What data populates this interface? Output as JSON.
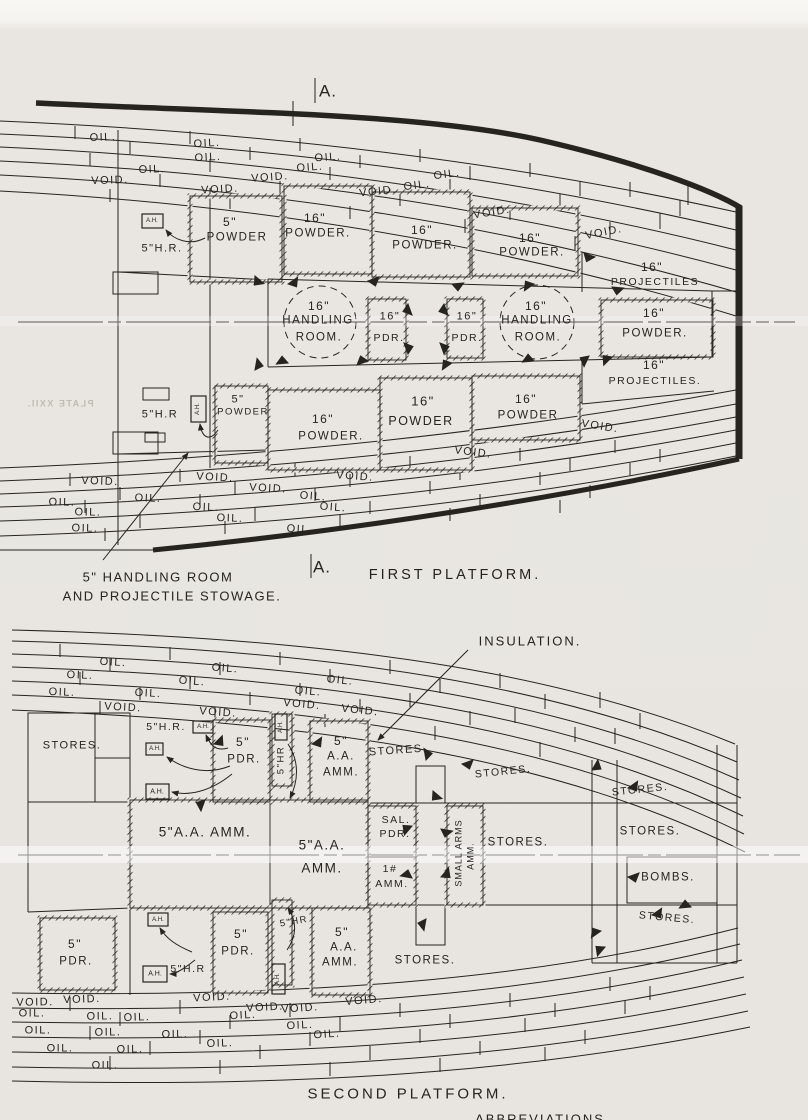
{
  "colors": {
    "paper": "#e8e5e0",
    "ink": "#26241f"
  },
  "figure": {
    "type": "warship deck plan, scanned technical drawing",
    "plans": [
      "FIRST PLATFORM.",
      "SECOND PLATFORM."
    ],
    "watermark": "PLATE XXII."
  },
  "labels": [
    {
      "t": "A.",
      "x": 328,
      "y": 91,
      "s": 17,
      "sp": 1,
      "n": "section-marker-a-top"
    },
    {
      "t": "OIL.",
      "x": 103,
      "y": 138,
      "r": -2
    },
    {
      "t": "OIL.",
      "x": 207,
      "y": 144,
      "r": -3
    },
    {
      "t": "OIL.",
      "x": 208,
      "y": 158,
      "r": -3
    },
    {
      "t": "OIL.",
      "x": 328,
      "y": 158,
      "r": -4
    },
    {
      "t": "OIL.",
      "x": 152,
      "y": 170,
      "r": -2
    },
    {
      "t": "OIL.",
      "x": 310,
      "y": 168,
      "r": -4
    },
    {
      "t": "OIL.",
      "x": 447,
      "y": 175,
      "r": -7
    },
    {
      "t": "OIL.",
      "x": 417,
      "y": 186,
      "r": -7
    },
    {
      "t": "VOID.",
      "x": 110,
      "y": 181,
      "r": -2
    },
    {
      "t": "VOID.",
      "x": 270,
      "y": 178,
      "r": -4
    },
    {
      "t": "VOID.",
      "x": 220,
      "y": 190,
      "r": -3
    },
    {
      "t": "VOID.",
      "x": 378,
      "y": 192,
      "r": -6
    },
    {
      "t": "VOID.",
      "x": 492,
      "y": 213,
      "r": -9
    },
    {
      "t": "VOID.",
      "x": 604,
      "y": 233,
      "r": -11
    },
    {
      "t": "A.H.",
      "x": 152,
      "y": 221,
      "s": 6,
      "sp": 0,
      "n": "ammunition-hoist-box"
    },
    {
      "t": "5\"H.R.",
      "x": 162,
      "y": 249,
      "s": 11,
      "n": "five-inch-handling-room"
    },
    {
      "t": "5\"",
      "x": 230,
      "y": 222,
      "s": 12
    },
    {
      "t": "POWDER",
      "x": 237,
      "y": 238,
      "s": 11.5
    },
    {
      "t": "16\"",
      "x": 315,
      "y": 218,
      "s": 12
    },
    {
      "t": "POWDER.",
      "x": 318,
      "y": 234,
      "s": 11.5
    },
    {
      "t": "16\"",
      "x": 422,
      "y": 230,
      "s": 12
    },
    {
      "t": "POWDER.",
      "x": 425,
      "y": 246,
      "s": 11.5
    },
    {
      "t": "16\"",
      "x": 530,
      "y": 238,
      "s": 12
    },
    {
      "t": "POWDER.",
      "x": 532,
      "y": 253,
      "s": 11.5
    },
    {
      "t": "16\"",
      "x": 652,
      "y": 267,
      "s": 12
    },
    {
      "t": "PROJECTILES",
      "x": 655,
      "y": 282,
      "s": 10.5
    },
    {
      "t": "16\"",
      "x": 319,
      "y": 306,
      "s": 12
    },
    {
      "t": "HANDLING",
      "x": 318,
      "y": 321,
      "s": 11.5
    },
    {
      "t": "ROOM.",
      "x": 319,
      "y": 338,
      "s": 11.5
    },
    {
      "t": "16\"",
      "x": 390,
      "y": 317,
      "s": 11
    },
    {
      "t": "PDR.",
      "x": 389,
      "y": 338,
      "s": 10.5
    },
    {
      "t": "16\"",
      "x": 467,
      "y": 317,
      "s": 11
    },
    {
      "t": "PDR.",
      "x": 467,
      "y": 338,
      "s": 10.5
    },
    {
      "t": "16\"",
      "x": 536,
      "y": 306,
      "s": 12
    },
    {
      "t": "HANDLING",
      "x": 537,
      "y": 321,
      "s": 11.5
    },
    {
      "t": "ROOM.",
      "x": 538,
      "y": 338,
      "s": 11.5
    },
    {
      "t": "16\"",
      "x": 654,
      "y": 313,
      "s": 12
    },
    {
      "t": "POWDER.",
      "x": 655,
      "y": 334,
      "s": 11.5
    },
    {
      "t": "16\"",
      "x": 654,
      "y": 365,
      "s": 12
    },
    {
      "t": "PROJECTILES.",
      "x": 655,
      "y": 381,
      "s": 10.5
    },
    {
      "t": "5\"",
      "x": 238,
      "y": 400,
      "s": 11
    },
    {
      "t": "POWDER",
      "x": 243,
      "y": 412,
      "s": 9.5
    },
    {
      "t": "5\"H.R",
      "x": 160,
      "y": 415,
      "s": 11
    },
    {
      "t": "A.H.",
      "x": 198,
      "y": 409,
      "s": 6,
      "sp": 0,
      "v": true,
      "n": "ammunition-hoist-box"
    },
    {
      "t": "16\"",
      "x": 323,
      "y": 419,
      "s": 12
    },
    {
      "t": "POWDER.",
      "x": 331,
      "y": 437,
      "s": 11.5
    },
    {
      "t": "16\"",
      "x": 423,
      "y": 401,
      "s": 13
    },
    {
      "t": "POWDER",
      "x": 421,
      "y": 421,
      "s": 12.5
    },
    {
      "t": "16\"",
      "x": 526,
      "y": 399,
      "s": 12
    },
    {
      "t": "POWDER",
      "x": 528,
      "y": 416,
      "s": 11.5
    },
    {
      "t": "VOID.",
      "x": 100,
      "y": 482,
      "r": 2
    },
    {
      "t": "VOID.",
      "x": 215,
      "y": 478,
      "r": 3
    },
    {
      "t": "VOID.",
      "x": 268,
      "y": 489,
      "r": 3
    },
    {
      "t": "VOID.",
      "x": 355,
      "y": 477,
      "r": 4
    },
    {
      "t": "VOID.",
      "x": 473,
      "y": 453,
      "r": 7
    },
    {
      "t": "VOID.",
      "x": 600,
      "y": 427,
      "r": 9
    },
    {
      "t": "OIL.",
      "x": 62,
      "y": 503,
      "r": 1
    },
    {
      "t": "OIL.",
      "x": 148,
      "y": 499,
      "r": 2
    },
    {
      "t": "OIL.",
      "x": 313,
      "y": 497,
      "r": 4
    },
    {
      "t": "OIL.",
      "x": 88,
      "y": 513,
      "r": 1
    },
    {
      "t": "OIL.",
      "x": 206,
      "y": 508,
      "r": 2
    },
    {
      "t": "OIL.",
      "x": 333,
      "y": 508,
      "r": 4
    },
    {
      "t": "OIL.",
      "x": 85,
      "y": 529,
      "r": 1
    },
    {
      "t": "OIL.",
      "x": 230,
      "y": 519,
      "r": 2
    },
    {
      "t": "OIL.",
      "x": 300,
      "y": 530,
      "r": 3
    },
    {
      "t": "A.",
      "x": 322,
      "y": 567,
      "s": 17,
      "sp": 1,
      "n": "section-marker-a-bottom"
    },
    {
      "t": "FIRST PLATFORM.",
      "x": 455,
      "y": 575,
      "s": 14.5,
      "sp": 3,
      "n": "caption-first-platform"
    },
    {
      "t": "5\" HANDLING ROOM",
      "x": 158,
      "y": 577,
      "s": 13,
      "sp": 1.5,
      "n": "note-line-1"
    },
    {
      "t": "AND PROJECTILE STOWAGE.",
      "x": 172,
      "y": 596,
      "s": 13,
      "sp": 1.5,
      "n": "note-line-2"
    },
    {
      "t": "PLATE XXII.",
      "x": 60,
      "y": 404,
      "s": 9,
      "cls": "mirror",
      "n": "bleedthrough-plate-number"
    },
    {
      "t": "INSULATION.",
      "x": 530,
      "y": 641,
      "s": 13,
      "sp": 2,
      "n": "note-insulation"
    },
    {
      "t": "OIL.",
      "x": 113,
      "y": 663,
      "r": 3
    },
    {
      "t": "OIL.",
      "x": 225,
      "y": 669,
      "r": 4
    },
    {
      "t": "OIL.",
      "x": 80,
      "y": 676,
      "r": 2
    },
    {
      "t": "OIL.",
      "x": 192,
      "y": 682,
      "r": 4
    },
    {
      "t": "OIL.",
      "x": 340,
      "y": 681,
      "r": 6
    },
    {
      "t": "OIL.",
      "x": 62,
      "y": 693,
      "r": 2
    },
    {
      "t": "OIL.",
      "x": 148,
      "y": 694,
      "r": 3
    },
    {
      "t": "OIL.",
      "x": 308,
      "y": 692,
      "r": 5
    },
    {
      "t": "VOID.",
      "x": 123,
      "y": 708,
      "r": 3
    },
    {
      "t": "VOID.",
      "x": 218,
      "y": 713,
      "r": 4
    },
    {
      "t": "VOID.",
      "x": 302,
      "y": 705,
      "r": 5
    },
    {
      "t": "VOID.",
      "x": 360,
      "y": 711,
      "r": 6
    },
    {
      "t": "STORES.",
      "x": 72,
      "y": 746,
      "s": 11
    },
    {
      "t": "5\"H.R.",
      "x": 166,
      "y": 727,
      "s": 10.5
    },
    {
      "t": "A.H.",
      "x": 203,
      "y": 727,
      "s": 6,
      "sp": 0
    },
    {
      "t": "A.H.",
      "x": 155,
      "y": 749,
      "s": 6,
      "sp": 0
    },
    {
      "t": "A.H.",
      "x": 157,
      "y": 792,
      "s": 7,
      "sp": 0
    },
    {
      "t": "A.H.",
      "x": 281,
      "y": 727,
      "s": 6,
      "sp": 0,
      "v": true
    },
    {
      "t": "5\"",
      "x": 243,
      "y": 742,
      "s": 12
    },
    {
      "t": "PDR.",
      "x": 244,
      "y": 760,
      "s": 11.5
    },
    {
      "t": "5\"HR",
      "x": 281,
      "y": 760,
      "s": 9.5,
      "v": true
    },
    {
      "t": "5\"",
      "x": 341,
      "y": 741,
      "s": 12
    },
    {
      "t": "A.A.",
      "x": 341,
      "y": 757,
      "s": 11.5
    },
    {
      "t": "AMM.",
      "x": 341,
      "y": 773,
      "s": 11.5
    },
    {
      "t": "STORES.",
      "x": 398,
      "y": 751,
      "s": 11,
      "r": -4
    },
    {
      "t": "STORES.",
      "x": 503,
      "y": 772,
      "s": 10.5,
      "r": -6
    },
    {
      "t": "STORES.",
      "x": 640,
      "y": 790,
      "s": 10.5,
      "r": -6
    },
    {
      "t": "5\"A.A. AMM.",
      "x": 205,
      "y": 832,
      "s": 13.5,
      "sp": 1.5
    },
    {
      "t": "5\"A.A.",
      "x": 322,
      "y": 845,
      "s": 13.5
    },
    {
      "t": "AMM.",
      "x": 322,
      "y": 868,
      "s": 13.5
    },
    {
      "t": "SAL.",
      "x": 396,
      "y": 820,
      "s": 10.5
    },
    {
      "t": "PDR.",
      "x": 395,
      "y": 834,
      "s": 10.5
    },
    {
      "t": "1#",
      "x": 390,
      "y": 869,
      "s": 10.5
    },
    {
      "t": "AMM.",
      "x": 392,
      "y": 884,
      "s": 10.5
    },
    {
      "t": "SMALL ARMS",
      "x": 459,
      "y": 853,
      "s": 9,
      "sp": 1,
      "v": true
    },
    {
      "t": "AMM.",
      "x": 471,
      "y": 856,
      "s": 9,
      "sp": 1,
      "v": true
    },
    {
      "t": "STORES.",
      "x": 518,
      "y": 843,
      "s": 11.5
    },
    {
      "t": "STORES.",
      "x": 650,
      "y": 832,
      "s": 11.5
    },
    {
      "t": "BOMBS.",
      "x": 668,
      "y": 878,
      "s": 11.5
    },
    {
      "t": "STORES.",
      "x": 667,
      "y": 918,
      "s": 10.5,
      "r": 5
    },
    {
      "t": "5\"",
      "x": 75,
      "y": 944,
      "s": 12
    },
    {
      "t": "PDR.",
      "x": 76,
      "y": 962,
      "s": 11.5
    },
    {
      "t": "A.H.",
      "x": 158,
      "y": 920,
      "s": 6,
      "sp": 0
    },
    {
      "t": "A.H.",
      "x": 155,
      "y": 974,
      "s": 7,
      "sp": 0
    },
    {
      "t": "5\"H.R",
      "x": 188,
      "y": 969,
      "s": 10.5
    },
    {
      "t": "5\"",
      "x": 241,
      "y": 934,
      "s": 12
    },
    {
      "t": "PDR.",
      "x": 238,
      "y": 952,
      "s": 11.5
    },
    {
      "t": "5\"HR",
      "x": 294,
      "y": 922,
      "s": 9.5,
      "r": -10
    },
    {
      "t": "A.H.",
      "x": 278,
      "y": 979,
      "s": 6,
      "sp": 0,
      "v": true
    },
    {
      "t": "5\"",
      "x": 342,
      "y": 932,
      "s": 12
    },
    {
      "t": "A.A.",
      "x": 344,
      "y": 948,
      "s": 11.5
    },
    {
      "t": "AMM.",
      "x": 340,
      "y": 963,
      "s": 11.5
    },
    {
      "t": "STORES.",
      "x": 425,
      "y": 961,
      "s": 11.5
    },
    {
      "t": "VOID.",
      "x": 35,
      "y": 1003,
      "r": -1
    },
    {
      "t": "VOID.",
      "x": 82,
      "y": 1000,
      "r": -2
    },
    {
      "t": "VOID.",
      "x": 212,
      "y": 998,
      "r": -3
    },
    {
      "t": "VOID.",
      "x": 265,
      "y": 1008,
      "r": -3
    },
    {
      "t": "VOID.",
      "x": 300,
      "y": 1009,
      "r": -4
    },
    {
      "t": "VOID.",
      "x": 364,
      "y": 1001,
      "r": -5
    },
    {
      "t": "OIL.",
      "x": 137,
      "y": 1018,
      "r": -2
    },
    {
      "t": "OIL.",
      "x": 243,
      "y": 1016,
      "r": -3
    },
    {
      "t": "OIL.",
      "x": 300,
      "y": 1026,
      "r": -3
    },
    {
      "t": "OIL.",
      "x": 327,
      "y": 1035,
      "r": -4
    },
    {
      "t": "OIL.",
      "x": 220,
      "y": 1044,
      "r": -2
    },
    {
      "t": "OIL.",
      "x": 32,
      "y": 1014
    },
    {
      "t": "OIL.",
      "x": 100,
      "y": 1017,
      "r": -1
    },
    {
      "t": "OIL.",
      "x": 38,
      "y": 1031
    },
    {
      "t": "OIL.",
      "x": 108,
      "y": 1033,
      "r": -1
    },
    {
      "t": "OIL.",
      "x": 175,
      "y": 1035,
      "r": -1
    },
    {
      "t": "OIL.",
      "x": 60,
      "y": 1049
    },
    {
      "t": "OIL.",
      "x": 130,
      "y": 1050,
      "r": -1
    },
    {
      "t": "OIL.",
      "x": 105,
      "y": 1066
    },
    {
      "t": "SECOND PLATFORM.",
      "x": 408,
      "y": 1094,
      "s": 15,
      "sp": 3,
      "n": "caption-second-platform"
    },
    {
      "t": "ABBREVIATIONS",
      "x": 540,
      "y": 1119,
      "s": 13,
      "sp": 2,
      "n": "caption-abbreviations-partial"
    }
  ]
}
